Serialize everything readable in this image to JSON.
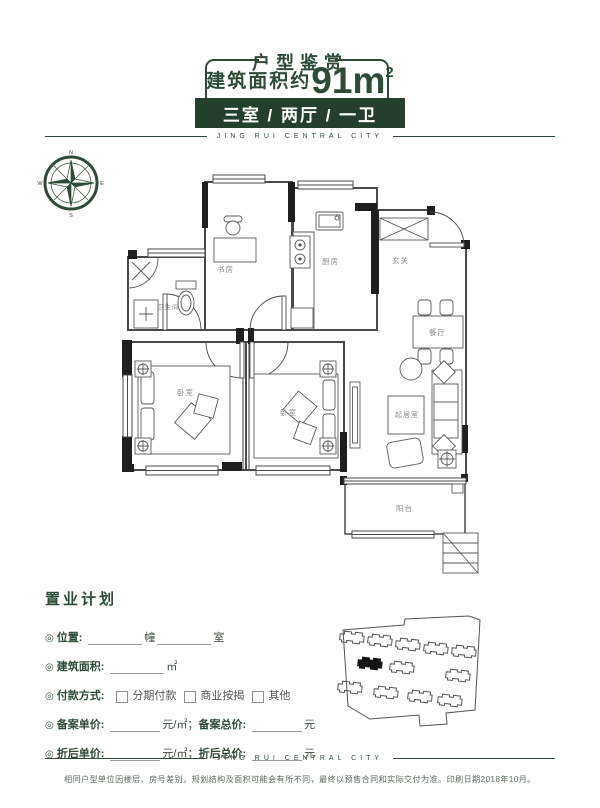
{
  "theme": {
    "accent_green": "#2e4b38",
    "badge_green": "#24402d",
    "plan_line": "#4a4a4a",
    "wall_fill": "#1f1f1f"
  },
  "header": {
    "title": "户型鉴赏",
    "area_label": "建筑面积约",
    "area_value": "91m",
    "area_sup": "2",
    "badge": "三室 / 两厅 / 一卫"
  },
  "brand": {
    "name": "JING RUI CENTRAL CITY"
  },
  "compass": {
    "north": "N",
    "south": "S",
    "east": "E",
    "west": "W"
  },
  "floorplan": {
    "rooms": [
      {
        "id": "study",
        "label": "书房"
      },
      {
        "id": "kitchen",
        "label": "厨房"
      },
      {
        "id": "entry",
        "label": "玄关"
      },
      {
        "id": "bathroom",
        "label": "卫生间"
      },
      {
        "id": "dining",
        "label": "餐厅"
      },
      {
        "id": "bedroom1",
        "label": "卧室"
      },
      {
        "id": "bedroom2",
        "label": "卧室"
      },
      {
        "id": "living",
        "label": "起居室"
      },
      {
        "id": "balcony",
        "label": "阳台"
      }
    ]
  },
  "plan_form": {
    "title": "置业计划",
    "bullet": "◎",
    "location_label": "位置:",
    "location_unit_building": "幢",
    "location_unit_room": "室",
    "area_label": "建筑面积:",
    "area_unit": "㎡",
    "payment_label": "付款方式:",
    "payment_options": [
      "分期付款",
      "商业按揭",
      "其他"
    ],
    "record_unit_label": "备案单价:",
    "record_unit_suffix": "元/㎡；",
    "record_total_label": "备案总价:",
    "record_total_suffix": "元",
    "discount_unit_label": "折后单价:",
    "discount_unit_suffix": "元/㎡；",
    "discount_total_label": "折后总价:",
    "discount_total_suffix": "元"
  },
  "footer": {
    "brand": "JING RUI CENTRAL CITY",
    "disclaimer": "相同户型单位因楼层、房号差别，规划结构及面积可能会有所不同，最终以预售合同和实际交付为准。印刷日期2018年10月。"
  }
}
